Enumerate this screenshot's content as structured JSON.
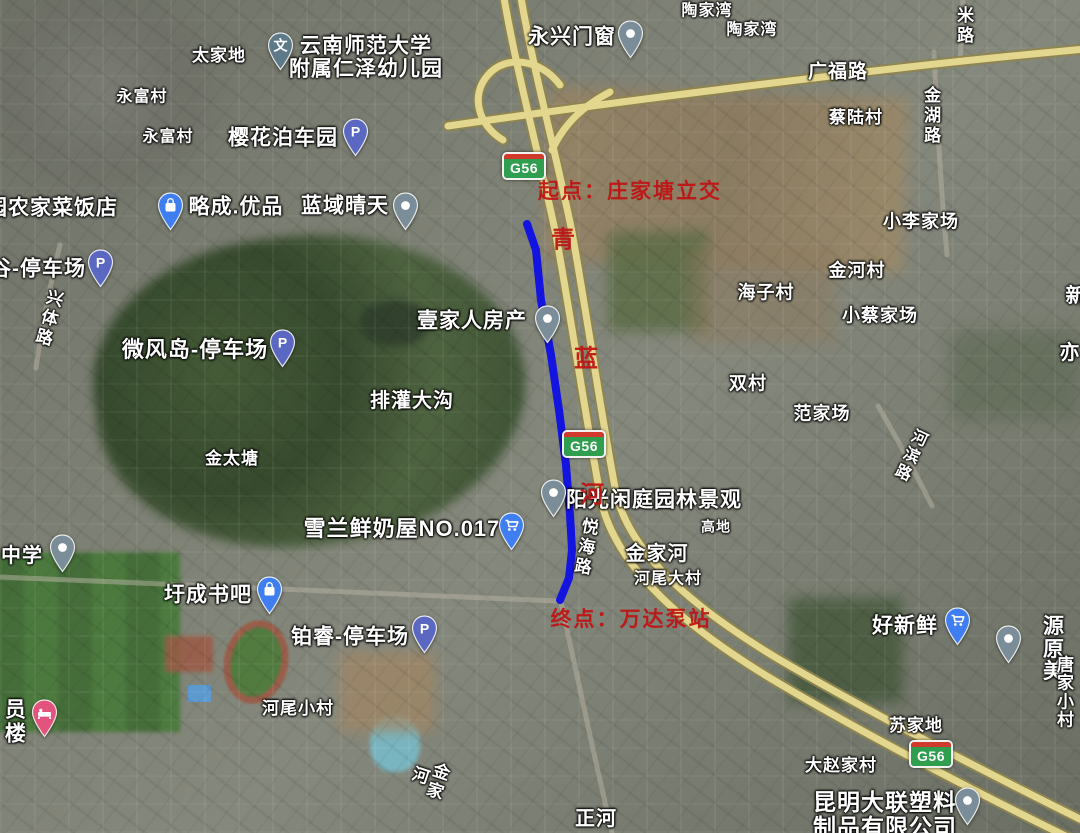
{
  "colors": {
    "route": "#1414e0",
    "red_annotation": "#c01212",
    "shield_green": "#2f9e4f",
    "shield_red": "#d0392c",
    "expressway_yellow": "#e3d68e",
    "pin_parking": "#5a68c2",
    "pin_school": "#5e7a89",
    "pin_gray": "#7b8d98",
    "pin_blue": "#3e7ef0",
    "pin_hotel": "#e2547e"
  },
  "annotations": {
    "color": "#c01212",
    "start": {
      "text": "起点：庄家塘立交",
      "x": 630,
      "y": 190,
      "size": 21
    },
    "end": {
      "text": "终点：万达泵站",
      "x": 631,
      "y": 618,
      "size": 21
    },
    "vertical_chars": [
      {
        "text": "青",
        "x": 563,
        "y": 237,
        "size": 24
      },
      {
        "text": "蓝",
        "x": 586,
        "y": 356,
        "size": 24
      },
      {
        "text": "河",
        "x": 592,
        "y": 492,
        "size": 24
      }
    ]
  },
  "route": {
    "color": "#1414e0",
    "width": 8,
    "points": [
      [
        527,
        224
      ],
      [
        536,
        250
      ],
      [
        541,
        300
      ],
      [
        551,
        355
      ],
      [
        559,
        410
      ],
      [
        566,
        465
      ],
      [
        570,
        515
      ],
      [
        572,
        550
      ],
      [
        569,
        578
      ],
      [
        560,
        600
      ]
    ]
  },
  "shields": [
    {
      "label": "G56",
      "x": 524,
      "y": 166
    },
    {
      "label": "G56",
      "x": 584,
      "y": 444
    },
    {
      "label": "G56",
      "x": 931,
      "y": 754
    }
  ],
  "labels": [
    {
      "text": "太家地",
      "x": 219,
      "y": 56,
      "size": 17,
      "kind": "village",
      "poi": false
    },
    {
      "text": "云南师范大学\n附属仁泽幼儿园",
      "x": 366,
      "y": 58,
      "size": 21,
      "kind": "poi",
      "poi": true
    },
    {
      "text": "永富村",
      "x": 142,
      "y": 97,
      "size": 16,
      "kind": "village",
      "poi": false
    },
    {
      "text": "永富村",
      "x": 168,
      "y": 137,
      "size": 16,
      "kind": "village",
      "poi": false
    },
    {
      "text": "樱花泊车园",
      "x": 283,
      "y": 139,
      "size": 21,
      "kind": "poi",
      "poi": true
    },
    {
      "text": "园农家菜饭店",
      "x": 52,
      "y": 209,
      "size": 21,
      "kind": "poi",
      "poi": true
    },
    {
      "text": "略成.优品",
      "x": 236,
      "y": 208,
      "size": 21,
      "kind": "poi",
      "poi": true
    },
    {
      "text": "蓝域晴天",
      "x": 345,
      "y": 207,
      "size": 21,
      "kind": "poi",
      "poi": true
    },
    {
      "text": "永兴门窗",
      "x": 572,
      "y": 38,
      "size": 21,
      "kind": "poi",
      "poi": true
    },
    {
      "text": "陶家湾",
      "x": 707,
      "y": 11,
      "size": 16,
      "kind": "village",
      "poi": false
    },
    {
      "text": "陶家湾",
      "x": 752,
      "y": 30,
      "size": 16,
      "kind": "village",
      "poi": false
    },
    {
      "text": "广福路",
      "x": 838,
      "y": 73,
      "size": 19,
      "kind": "road",
      "poi": false
    },
    {
      "text": "蔡陆村",
      "x": 856,
      "y": 118,
      "size": 17,
      "kind": "village",
      "poi": false
    },
    {
      "text": "金湖路",
      "x": 930,
      "y": 116,
      "size": 17,
      "kind": "road",
      "vertical": true,
      "poi": false
    },
    {
      "text": "米路",
      "x": 963,
      "y": 26,
      "size": 17,
      "kind": "road",
      "vertical": true,
      "poi": false
    },
    {
      "text": "小李家场",
      "x": 921,
      "y": 222,
      "size": 18,
      "kind": "village",
      "poi": false
    },
    {
      "text": "金河村",
      "x": 857,
      "y": 271,
      "size": 18,
      "kind": "village",
      "poi": false
    },
    {
      "text": "海子村",
      "x": 766,
      "y": 293,
      "size": 18,
      "kind": "village",
      "poi": false
    },
    {
      "text": "小蔡家场",
      "x": 880,
      "y": 316,
      "size": 18,
      "kind": "village",
      "poi": false
    },
    {
      "text": "新",
      "x": 1076,
      "y": 297,
      "size": 20,
      "kind": "village",
      "poi": false
    },
    {
      "text": "亦",
      "x": 1070,
      "y": 354,
      "size": 20,
      "kind": "village",
      "poi": false
    },
    {
      "text": "双村",
      "x": 748,
      "y": 384,
      "size": 18,
      "kind": "village",
      "poi": false
    },
    {
      "text": "范家场",
      "x": 822,
      "y": 414,
      "size": 18,
      "kind": "village",
      "poi": false
    },
    {
      "text": "谷-停车场",
      "x": 38,
      "y": 270,
      "size": 21,
      "kind": "poi",
      "poi": true
    },
    {
      "text": "兴体路",
      "x": 47,
      "y": 318,
      "size": 17,
      "kind": "road",
      "vertical": true,
      "rotate": 15,
      "poi": false
    },
    {
      "text": "微风岛-停车场",
      "x": 195,
      "y": 350,
      "size": 22,
      "kind": "poi",
      "poi": true
    },
    {
      "text": "排灌大沟",
      "x": 412,
      "y": 402,
      "size": 20,
      "kind": "village",
      "poi": false
    },
    {
      "text": "金太塘",
      "x": 232,
      "y": 459,
      "size": 17,
      "kind": "village",
      "poi": false
    },
    {
      "text": "壹家人房产",
      "x": 472,
      "y": 322,
      "size": 21,
      "kind": "poi",
      "poi": true
    },
    {
      "text": "雪兰鲜奶屋NO.017",
      "x": 402,
      "y": 529,
      "size": 22,
      "kind": "poi",
      "poi": true
    },
    {
      "text": "阳光闲庭园林景观",
      "x": 654,
      "y": 501,
      "size": 21,
      "kind": "poi",
      "poi": true
    },
    {
      "text": "悦海路",
      "x": 584,
      "y": 547,
      "size": 17,
      "kind": "road",
      "vertical": true,
      "rotate": 10,
      "poi": false
    },
    {
      "text": "金家河",
      "x": 657,
      "y": 555,
      "size": 20,
      "kind": "village",
      "poi": false
    },
    {
      "text": "河尾大村",
      "x": 668,
      "y": 579,
      "size": 16,
      "kind": "village",
      "poi": false
    },
    {
      "text": "高地",
      "x": 716,
      "y": 527,
      "size": 14,
      "kind": "village",
      "poi": false
    },
    {
      "text": "河滨路",
      "x": 909,
      "y": 455,
      "size": 16,
      "kind": "road",
      "vertical": true,
      "rotate": 25,
      "poi": false
    },
    {
      "text": "中学",
      "x": 22,
      "y": 557,
      "size": 20,
      "kind": "poi",
      "poi": true
    },
    {
      "text": "圩成书吧",
      "x": 208,
      "y": 596,
      "size": 21,
      "kind": "poi",
      "poi": true
    },
    {
      "text": "铂睿-停车场",
      "x": 350,
      "y": 638,
      "size": 21,
      "kind": "poi",
      "poi": true
    },
    {
      "text": "员楼",
      "x": 13,
      "y": 722,
      "size": 21,
      "kind": "poi",
      "vertical": true,
      "poi": true
    },
    {
      "text": "河尾小村",
      "x": 298,
      "y": 709,
      "size": 17,
      "kind": "village",
      "poi": false
    },
    {
      "text": "金家河",
      "x": 427,
      "y": 778,
      "size": 17,
      "kind": "village",
      "vertical": true,
      "rotate": 18,
      "poi": false
    },
    {
      "text": "正河",
      "x": 596,
      "y": 820,
      "size": 20,
      "kind": "village",
      "poi": false
    },
    {
      "text": "好新鲜",
      "x": 905,
      "y": 627,
      "size": 21,
      "kind": "poi",
      "poi": true
    },
    {
      "text": "源原美",
      "x": 1054,
      "y": 650,
      "size": 21,
      "kind": "poi",
      "poi": true
    },
    {
      "text": "唐家小村",
      "x": 1066,
      "y": 693,
      "size": 17,
      "kind": "village",
      "poi": false
    },
    {
      "text": "苏家地",
      "x": 916,
      "y": 726,
      "size": 17,
      "kind": "village",
      "poi": false
    },
    {
      "text": "大赵家村",
      "x": 841,
      "y": 766,
      "size": 17,
      "kind": "village",
      "poi": false
    },
    {
      "text": "昆明大联塑料\n制品有限公司",
      "x": 885,
      "y": 815,
      "size": 23,
      "kind": "poi",
      "poi": true
    }
  ],
  "pins": [
    {
      "type": "kindergarten",
      "icon": "school-wen-icon",
      "x": 280,
      "y": 45,
      "color": "#5e7a89",
      "glyph": "文"
    },
    {
      "type": "parking",
      "icon": "parking-icon",
      "x": 355,
      "y": 131,
      "color": "#5a68c2",
      "glyph": "P"
    },
    {
      "type": "bag",
      "icon": "shopping-bag-icon",
      "x": 170,
      "y": 205,
      "color": "#3e7ef0"
    },
    {
      "type": "dot",
      "icon": "dot-icon",
      "x": 405,
      "y": 205,
      "color": "#7b8d98"
    },
    {
      "type": "parking",
      "icon": "parking-icon",
      "x": 100,
      "y": 262,
      "color": "#5a68c2",
      "glyph": "P"
    },
    {
      "type": "parking",
      "icon": "parking-icon",
      "x": 282,
      "y": 342,
      "color": "#5a68c2",
      "glyph": "P"
    },
    {
      "type": "dot",
      "icon": "dot-icon",
      "x": 547,
      "y": 318,
      "color": "#7b8d98"
    },
    {
      "type": "dot",
      "icon": "dot-icon",
      "x": 553,
      "y": 492,
      "color": "#7b8d98"
    },
    {
      "type": "cart",
      "icon": "shopping-cart-icon",
      "x": 511,
      "y": 525,
      "color": "#3e7ef0"
    },
    {
      "type": "bag",
      "icon": "shopping-bag-icon",
      "x": 269,
      "y": 589,
      "color": "#3e7ef0"
    },
    {
      "type": "parking",
      "icon": "parking-icon",
      "x": 424,
      "y": 628,
      "color": "#5a68c2",
      "glyph": "P"
    },
    {
      "type": "dot",
      "icon": "dot-icon",
      "x": 62,
      "y": 547,
      "color": "#7b8d98"
    },
    {
      "type": "hotel",
      "icon": "hotel-bed-icon",
      "x": 44,
      "y": 712,
      "color": "#e2547e"
    },
    {
      "type": "cart",
      "icon": "shopping-cart-icon",
      "x": 957,
      "y": 620,
      "color": "#3e7ef0"
    },
    {
      "type": "dot",
      "icon": "dot-icon",
      "x": 1008,
      "y": 638,
      "color": "#7b8d98"
    },
    {
      "type": "dot",
      "icon": "dot-icon",
      "x": 967,
      "y": 800,
      "color": "#7b8d98"
    },
    {
      "type": "dot",
      "icon": "dot-icon",
      "x": 630,
      "y": 33,
      "color": "#7b8d98"
    }
  ]
}
